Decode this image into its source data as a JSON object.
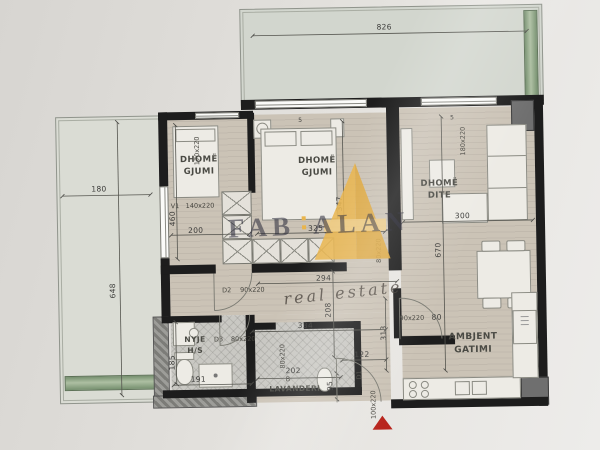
{
  "watermark": {
    "brand_word1": "FAB",
    "brand_word2": "ALAN",
    "tagline": "real estate"
  },
  "rooms": {
    "bedroom_left": {
      "line1": "DHOMË",
      "line2": "GJUMI"
    },
    "bedroom_center": {
      "line1": "DHOMË",
      "line2": "GJUMI"
    },
    "living": {
      "line1": "DHOMË",
      "line2": "DITE"
    },
    "kitchen": {
      "line1": "AMBJENT",
      "line2": "GATIMI"
    },
    "bathroom": {
      "line1": "NYJE",
      "line2": "H/S"
    },
    "laundry": {
      "line1": "LAVANDERI",
      "note": "B"
    }
  },
  "dimensions": {
    "terrace_width": "826",
    "balcony_width": "180",
    "balcony_length": "648",
    "bedroom_left_height": "460",
    "bedroom_left_width": "200",
    "bedroom_center_height": "347",
    "bedroom_center_width": "325",
    "hall_width": "294",
    "hall_height": "208",
    "hall_total_width": "334",
    "entry_height": "313",
    "entry_width": "122",
    "living_width": "300",
    "living_height": "670",
    "laundry_width": "202",
    "laundry_height": "95",
    "bathroom_width": "191",
    "bathroom_height": "185",
    "kitchen_door_offset": "80",
    "tick_left": "5",
    "tick_right": "5"
  },
  "openings": {
    "window_v1_code": "V1",
    "window_v1_size": "140x220",
    "bedroom_left_door_size": "170x220",
    "door_d2_code": "D2",
    "door_d2_size": "90x220",
    "door_d3_code": "D3",
    "door_d3_size": "80x220",
    "laundry_door_size": "80x220",
    "hall_passage_size": "80x220",
    "kitchen_door_size": "90x220",
    "entry_door_code": "D1",
    "entry_door_size": "100x220",
    "living_window_size": "180x220"
  },
  "colors": {
    "paper": "#e3e1dd",
    "floor_wood": "#cbc3b6",
    "wall": "#1d1d1d",
    "terrace": "#d2d6ce",
    "planter_green": "#8aa183",
    "watermark_orange": "#e9b54d",
    "watermark_text": "#282838",
    "entrance_marker": "#b8251d"
  }
}
